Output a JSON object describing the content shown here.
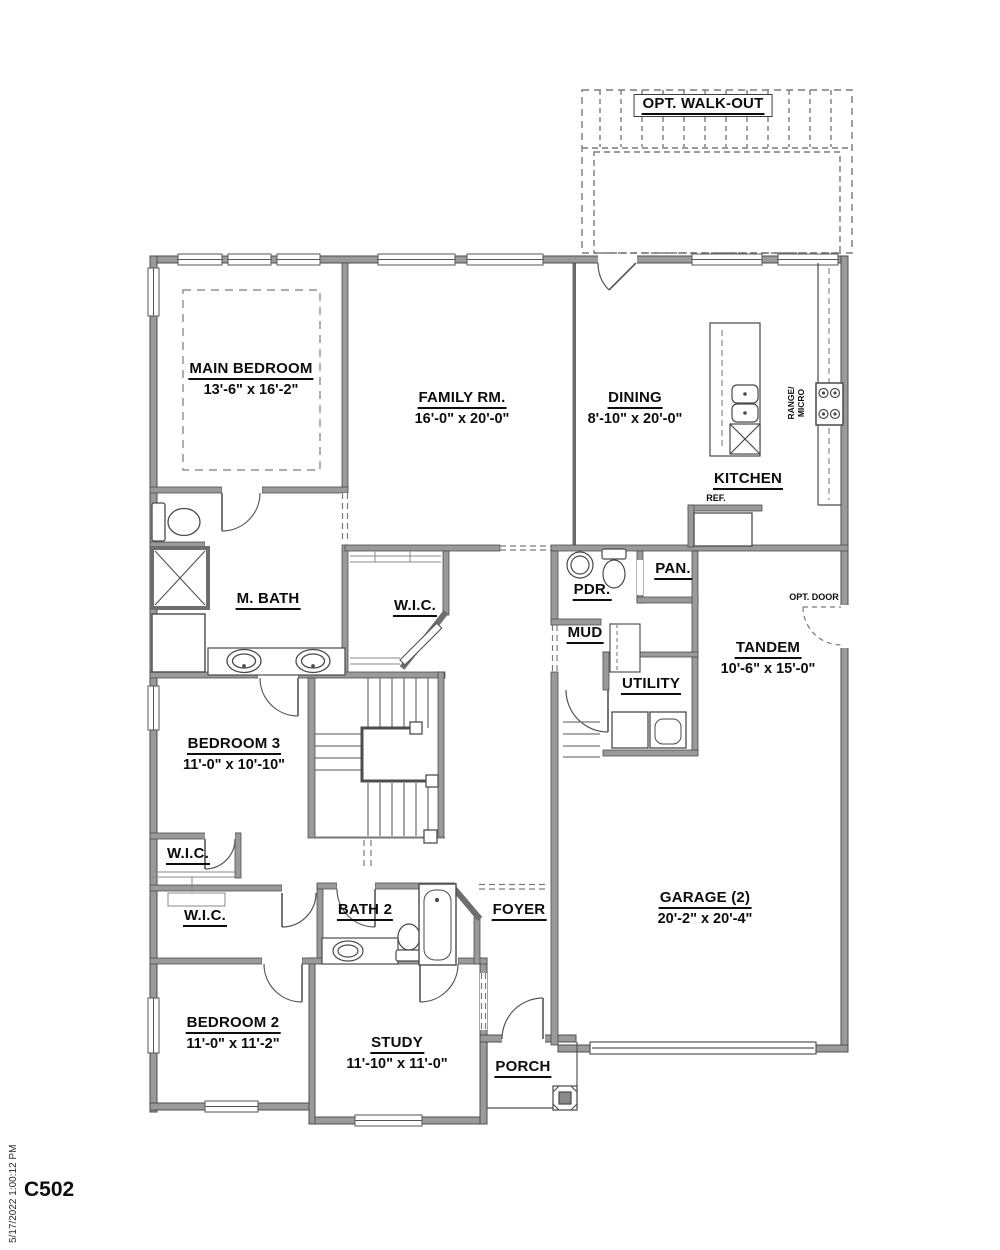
{
  "sheet": {
    "code": "C502",
    "plot_timestamp": "5/17/2022 1:00:12 PM"
  },
  "rooms": {
    "main_bedroom": {
      "name": "MAIN BEDROOM",
      "dims": "13'-6\" x 16'-2\""
    },
    "family_rm": {
      "name": "FAMILY RM.",
      "dims": "16'-0\" x 20'-0\""
    },
    "dining": {
      "name": "DINING",
      "dims": "8'-10\" x 20'-0\""
    },
    "kitchen": {
      "name": "KITCHEN"
    },
    "m_bath": {
      "name": "M. BATH"
    },
    "wic_main": {
      "name": "W.I.C."
    },
    "pdr": {
      "name": "PDR."
    },
    "pan": {
      "name": "PAN."
    },
    "mud": {
      "name": "MUD"
    },
    "utility": {
      "name": "UTILITY"
    },
    "tandem": {
      "name": "TANDEM",
      "dims": "10'-6\" x 15'-0\""
    },
    "bedroom3": {
      "name": "BEDROOM 3",
      "dims": "11'-0\" x 10'-10\""
    },
    "wic_hall_upper": {
      "name": "W.I.C."
    },
    "wic_hall_lower": {
      "name": "W.I.C."
    },
    "bath2": {
      "name": "BATH 2"
    },
    "foyer": {
      "name": "FOYER"
    },
    "garage": {
      "name": "GARAGE (2)",
      "dims": "20'-2\" x 20'-4\""
    },
    "bedroom2": {
      "name": "BEDROOM 2",
      "dims": "11'-0\" x 11'-2\""
    },
    "study": {
      "name": "STUDY",
      "dims": "11'-10\" x 11'-0\""
    },
    "porch": {
      "name": "PORCH"
    }
  },
  "annotations": {
    "opt_walkout": "OPT. WALK-OUT",
    "ref": "REF.",
    "range_line1": "RANGE/",
    "range_line2": "MICRO",
    "opt_door": "OPT. DOOR"
  },
  "colors": {
    "wall_fill": "#9a9a9a",
    "wall_edge": "#4d4d4d",
    "line": "#555555",
    "dash": "#7a7a7a",
    "text": "#0d0d0d"
  }
}
